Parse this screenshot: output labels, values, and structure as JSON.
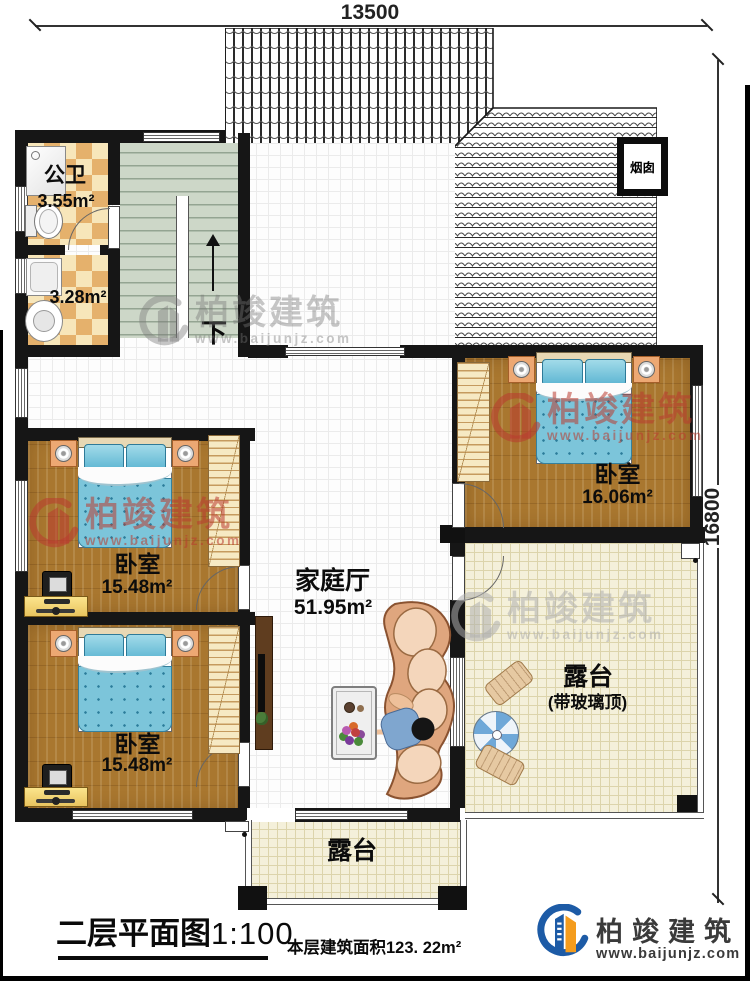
{
  "dimensions": {
    "top": "13500",
    "right": "16800"
  },
  "roof": {
    "chimney_label": "烟囱"
  },
  "stairs": {
    "down_label": "下"
  },
  "rooms": {
    "bathroom": {
      "name": "公卫",
      "area": "3.55m²"
    },
    "washroom": {
      "area": "3.28m²"
    },
    "bedroom1": {
      "name": "卧室",
      "area": "15.48m²"
    },
    "bedroom2": {
      "name": "卧室",
      "area": "15.48m²"
    },
    "bedroom3": {
      "name": "卧室",
      "area": "16.06m²"
    },
    "family_hall": {
      "name": "家庭厅",
      "area": "51.95m²"
    },
    "terrace_glass": {
      "name": "露台",
      "note": "(带玻璃顶)"
    },
    "terrace_bottom": {
      "name": "露台"
    }
  },
  "footer": {
    "title": "二层平面图",
    "scale": "1:100",
    "area_note": "本层建筑面积123. 22m²",
    "brand": "柏竣建筑",
    "website": "www.baijunjz.com"
  },
  "watermark": {
    "brand": "柏竣建筑",
    "website": "www.baijunjz.com"
  }
}
